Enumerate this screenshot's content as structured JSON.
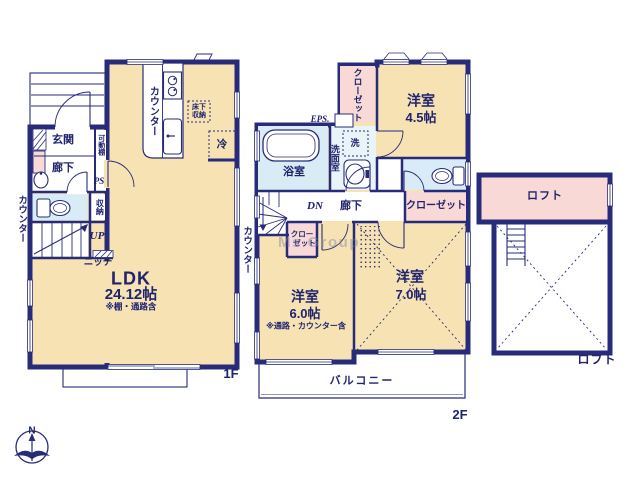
{
  "colors": {
    "wall_navy": "#282b7a",
    "text_navy": "#20236e",
    "room_cream": "#f6e2b2",
    "closet_pink": "#f8d9d6",
    "wet_area_blue": "#d9ecf5",
    "washroom_blue": "#e9f4f9"
  },
  "floor1": {
    "floor_label": "1F",
    "ldk": {
      "name": "LDK",
      "size": "24.12帖",
      "note": "※棚・通路含"
    },
    "genkan": "玄関",
    "hallway": "廊下",
    "movable_shelf": "可動棚",
    "pipe_space": "PS",
    "storage": "収納",
    "stairs_up": "UP",
    "niche": "ニッチ",
    "counter_left": "カウンター",
    "counter_kitchen": "カウンター",
    "counter_right": "カウンター",
    "underfloor_storage_l1": "床下",
    "underfloor_storage_l2": "収納",
    "fridge": "冷"
  },
  "floor2": {
    "floor_label": "2F",
    "room_45": {
      "name": "洋室",
      "size": "4.5帖"
    },
    "room_60": {
      "name": "洋室",
      "size": "6.0帖",
      "note": "※通路・カウンター含"
    },
    "room_70": {
      "name": "洋室",
      "size": "7.0帖"
    },
    "closet_top": "クローゼット",
    "closet_right": "クローゼット",
    "closet_small_l1": "クロー",
    "closet_small_l2": "ゼット",
    "eps": "EPS.",
    "bath": "浴室",
    "washroom": "洗面室",
    "washer": "洗",
    "hallway": "廊下",
    "stairs_down": "DN",
    "balcony": "バルコニー"
  },
  "loft": {
    "label_inner": "ロフト",
    "label_outer": "ロフト"
  },
  "compass": {
    "north": "N"
  },
  "watermark": "Ms Group"
}
